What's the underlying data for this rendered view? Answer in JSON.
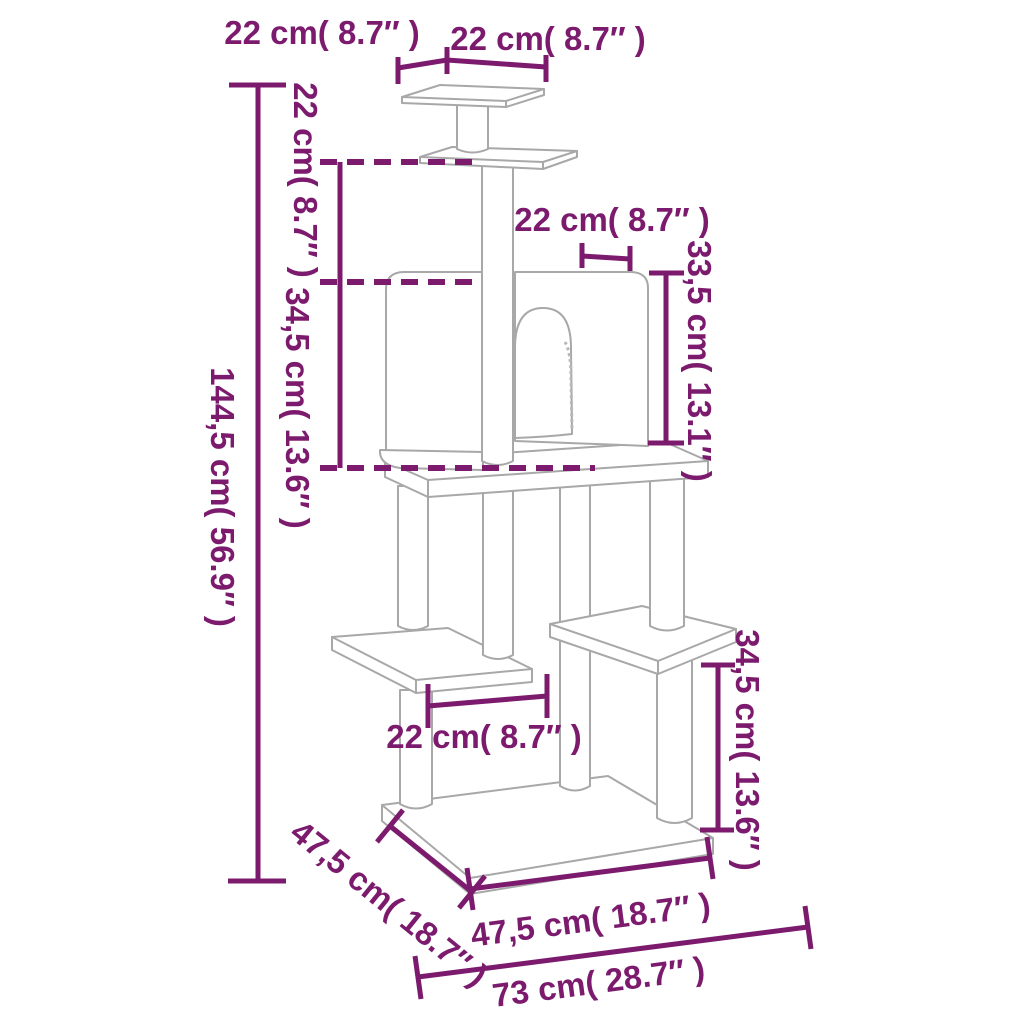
{
  "diagram": {
    "type": "product-dimension-diagram",
    "subject": "cat-tree-with-scratching-posts",
    "colors": {
      "dimension_annotations": "#7c1b6e",
      "product_outline": "#a8a8a8",
      "background": "#ffffff"
    },
    "labels": {
      "top_depth": "22 cm( 8.7″ )",
      "top_width": "22 cm( 8.7″ )",
      "upper_height": "22 cm( 8.7″ )",
      "mid_height": "34,5 cm( 13.6″ )",
      "total_height": "144,5 cm( 56.9″ )",
      "house_depth": "22 cm( 8.7″ )",
      "house_height": "33,5 cm( 13.1″ )",
      "step_width": "22 cm( 8.7″ )",
      "right_height": "34,5 cm( 13.6″ )",
      "base_depth": "47,5 cm( 18.7″ )",
      "base_width": "47,5 cm( 18.7″ )",
      "overall_width": "73 cm( 28.7″ )"
    },
    "measurements": [
      {
        "id": "top_depth",
        "cm": 22,
        "inch": 8.7,
        "what": "top platform depth"
      },
      {
        "id": "top_width",
        "cm": 22,
        "inch": 8.7,
        "what": "top platform width"
      },
      {
        "id": "upper_height",
        "cm": 22,
        "inch": 8.7,
        "what": "height between middle platform and condo roof"
      },
      {
        "id": "mid_height",
        "cm": 34.5,
        "inch": 13.6,
        "what": "condo section height"
      },
      {
        "id": "total_height",
        "cm": 144.5,
        "inch": 56.9,
        "what": "total height"
      },
      {
        "id": "house_depth",
        "cm": 22,
        "inch": 8.7,
        "what": "condo roof depth"
      },
      {
        "id": "house_height",
        "cm": 33.5,
        "inch": 13.1,
        "what": "condo front height"
      },
      {
        "id": "step_width",
        "cm": 22,
        "inch": 8.7,
        "what": "lower platform width"
      },
      {
        "id": "right_height",
        "cm": 34.5,
        "inch": 13.6,
        "what": "right platform height above base"
      },
      {
        "id": "base_depth",
        "cm": 47.5,
        "inch": 18.7,
        "what": "base depth"
      },
      {
        "id": "base_width",
        "cm": 47.5,
        "inch": 18.7,
        "what": "base front width"
      },
      {
        "id": "overall_width",
        "cm": 73,
        "inch": 28.7,
        "what": "overall width"
      }
    ]
  }
}
